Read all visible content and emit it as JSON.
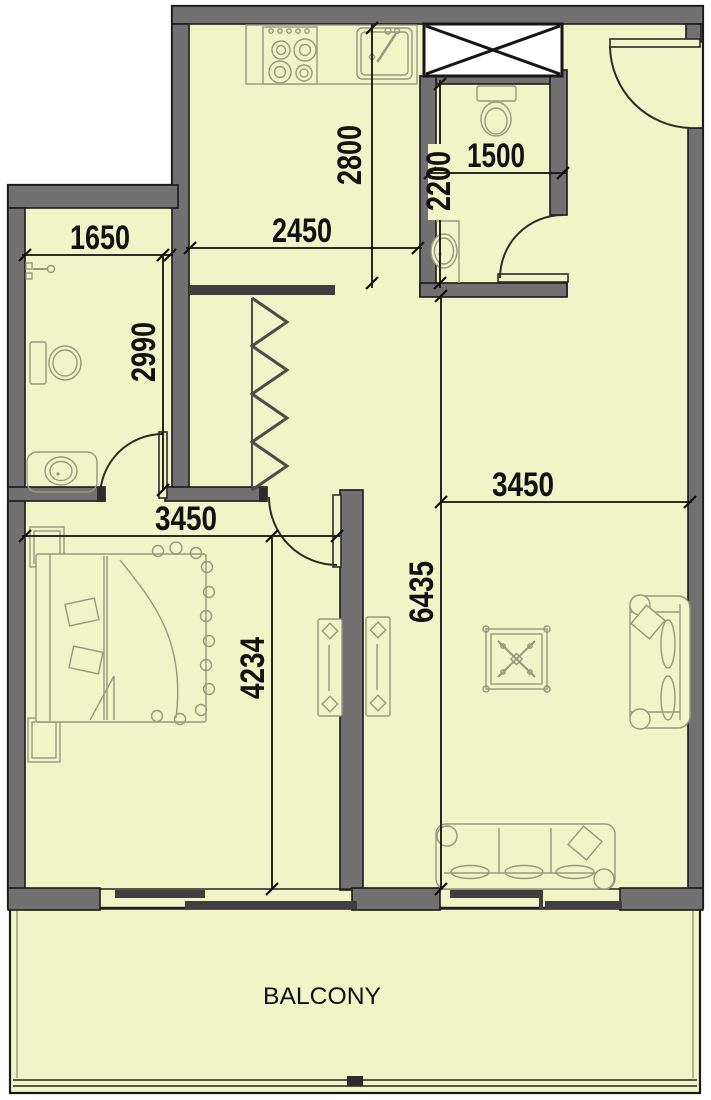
{
  "colors": {
    "floor": "#f0f4c6",
    "wall_fill": "#717171",
    "wall_stroke": "#1a1a1a",
    "fixture": "#98987e",
    "dim": "#111111"
  },
  "labels": {
    "balcony": "BALCONY"
  },
  "dimensions": {
    "kitchen_depth": "2800",
    "kitchen_width": "2450",
    "bath_top_depth": "2200",
    "bath_top_width": "1500",
    "bath_left_width": "1650",
    "bath_left_depth": "2990",
    "bedroom_width": "3450",
    "bedroom_depth": "4234",
    "living_width": "3450",
    "living_depth": "6435"
  }
}
